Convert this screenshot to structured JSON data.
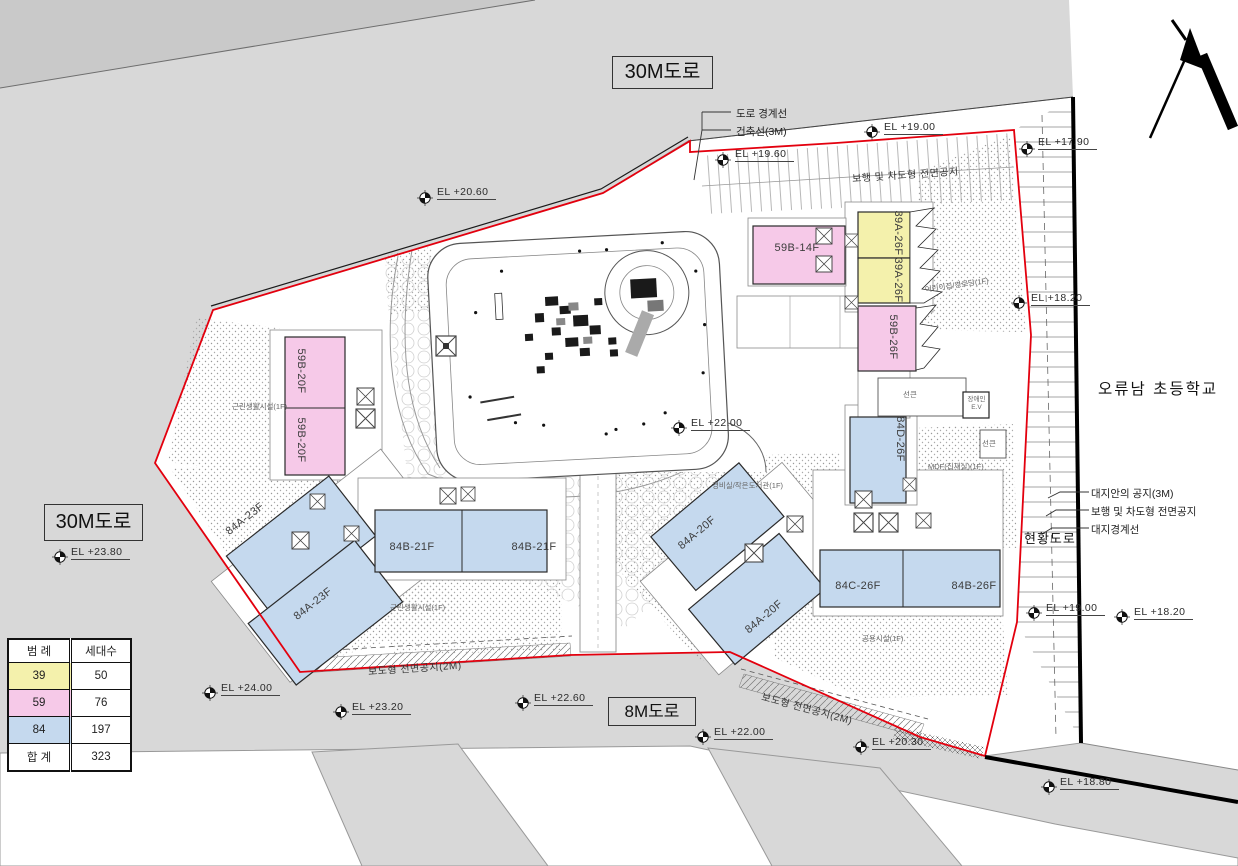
{
  "title_labels": {
    "road_top": "30M도로",
    "road_left": "30M도로",
    "road_bottom": "8M도로",
    "school": "오류남 초등학교"
  },
  "annotations": {
    "road_boundary": "도로 경계선",
    "building_line": "건축선(3M)",
    "site_open_space": "대지안의 공지(3M)",
    "ped_vehicle_space": "보행 및 차도형 전면공지",
    "site_boundary": "대지경계선",
    "existing_road": "현황도로",
    "strip_top": "보행 및 차도형 전면공지",
    "strip_bottom_left": "보도형 전면공지(2M)",
    "strip_bottom_right": "보도형 전면공지(2M)"
  },
  "buildings": [
    {
      "label": "59B-14F",
      "type": "59"
    },
    {
      "label": "39A-26F",
      "type": "39"
    },
    {
      "label": "39A-26F",
      "type": "39"
    },
    {
      "label": "59B-26F",
      "type": "59"
    },
    {
      "label": "59B-20F",
      "type": "59"
    },
    {
      "label": "59B-20F",
      "type": "59"
    },
    {
      "label": "84A-23F",
      "type": "84"
    },
    {
      "label": "84A-23F",
      "type": "84"
    },
    {
      "label": "84B-21F",
      "type": "84"
    },
    {
      "label": "84B-21F",
      "type": "84"
    },
    {
      "label": "84A-20F",
      "type": "84"
    },
    {
      "label": "84A-20F",
      "type": "84"
    },
    {
      "label": "84D-26F",
      "type": "84"
    },
    {
      "label": "84C-26F",
      "type": "84"
    },
    {
      "label": "84B-26F",
      "type": "84"
    }
  ],
  "facilities": [
    "근린생활시설(1F)",
    "근린생활시설(1F)",
    "경비실/작은도서관(1F)",
    "공용시설(1F)",
    "MDF(집재실)(1F)",
    "어린이집/경로당(1F)",
    "선큰",
    "선큰",
    "장애인 E.V"
  ],
  "el_markers": [
    {
      "label": "EL +20.60"
    },
    {
      "label": "EL +19.60"
    },
    {
      "label": "EL +19.00"
    },
    {
      "label": "EL +17.90"
    },
    {
      "label": "EL +18.20"
    },
    {
      "label": "EL +22.00"
    },
    {
      "label": "EL +23.80"
    },
    {
      "label": "EL +24.00"
    },
    {
      "label": "EL +23.20"
    },
    {
      "label": "EL +22.60"
    },
    {
      "label": "EL +22.00"
    },
    {
      "label": "EL +20.30"
    },
    {
      "label": "EL +18.80"
    },
    {
      "label": "EL +19.00"
    },
    {
      "label": "EL +18.20"
    }
  ],
  "legend": {
    "header": [
      "범 례",
      "세대수"
    ],
    "rows": [
      {
        "type": "39",
        "count": "50",
        "color": "#f4f1ac"
      },
      {
        "type": "59",
        "count": "76",
        "color": "#f6c9e8"
      },
      {
        "type": "84",
        "count": "197",
        "color": "#c5d9ee"
      }
    ],
    "total_label": "합 계",
    "total_count": "323"
  },
  "colors": {
    "type39": "#f4f1ac",
    "type59": "#f6c9e8",
    "type84": "#c5d9ee",
    "boundary_red": "#e3000e",
    "road_gray": "#d8d8d8"
  }
}
